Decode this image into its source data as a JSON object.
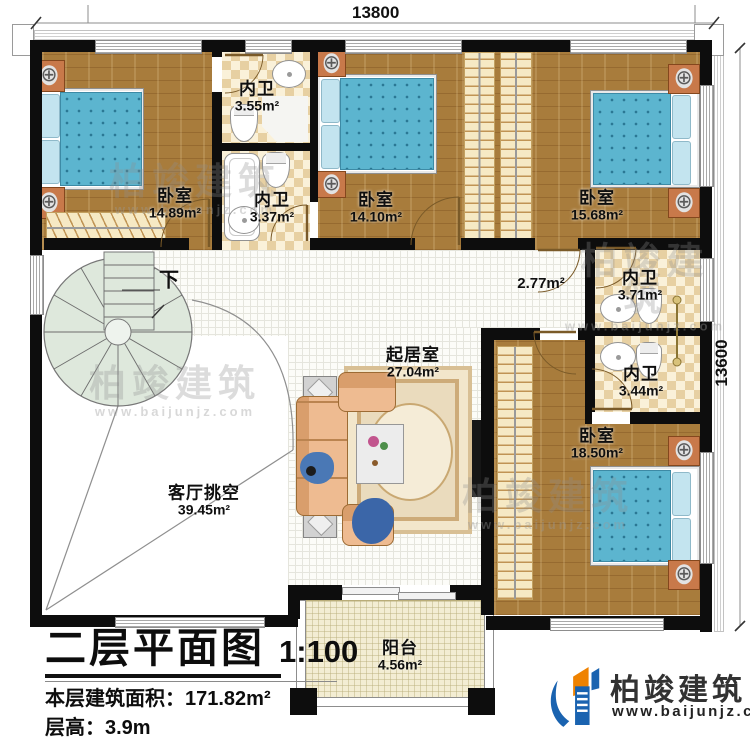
{
  "dimensions": {
    "top": "13800",
    "right": "13600"
  },
  "rooms": {
    "bedroom_top_left": {
      "name": "卧室",
      "area": "14.89m²"
    },
    "bath_inner_top": {
      "name": "内卫",
      "area": "3.55m²"
    },
    "bath_inner_mid": {
      "name": "内卫",
      "area": "3.37m²"
    },
    "bedroom_top_center": {
      "name": "卧室",
      "area": "14.10m²"
    },
    "bedroom_top_right": {
      "name": "卧室",
      "area": "15.68m²"
    },
    "bath_right_upper": {
      "name": "内卫",
      "area": "3.71m²"
    },
    "bath_right_lower": {
      "name": "内卫",
      "area": "3.44m²"
    },
    "bedroom_bottom_right": {
      "name": "卧室",
      "area": "18.50m²"
    },
    "living_room": {
      "name": "起居室",
      "area": "27.04m²"
    },
    "hallway": {
      "area": "2.77m²"
    },
    "void": {
      "name": "客厅挑空",
      "area": "39.45m²"
    },
    "balcony": {
      "name": "阳台",
      "area": "4.56m²"
    }
  },
  "stair": {
    "direction_label": "下"
  },
  "title_block": {
    "title": "二层平面图",
    "scale": "1:100",
    "area_label": "本层建筑面积：",
    "area_value": "171.82m²",
    "height_label": "层高：",
    "height_value": "3.9m"
  },
  "branding": {
    "company": "柏竣建筑",
    "website": "www.baijunjz.com"
  },
  "watermark": {
    "company": "柏竣建筑",
    "website": "www.baijunjz.com"
  },
  "colors": {
    "accent_blue": "#1a63b0",
    "accent_orange": "#ef8200",
    "bed_blue": "#5cb5cf",
    "wood": "#a87c3c"
  }
}
